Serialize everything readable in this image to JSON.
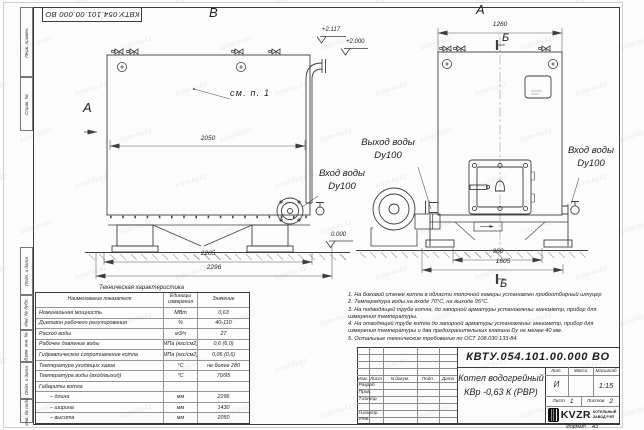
{
  "sheet": {
    "doc_number_top": "КВТУ.054.101.00.000 ВО",
    "format_label": "Формат",
    "format_value": "А3",
    "watermark": "kotel-kv.kz"
  },
  "margin_stamps": [
    "Перв. примен.",
    "Справ. №",
    "Подп. и дата",
    "Инв. № дубл.",
    "Взам. инв. №",
    "Подп. и дата",
    "Инв. № подл."
  ],
  "views": {
    "view_b": "В",
    "view_a": "А",
    "view_a_arrow": "А",
    "section_top": "Б",
    "section_bottom": "Б",
    "see_note": "см. п. 1",
    "elev_pipe": "+2.117",
    "elev_top": "+2.000",
    "elev_ground": "0.000",
    "dim_body": "2050",
    "dim_frame": "2205",
    "dim_total": "2296",
    "dim_width_top": "1260",
    "dim_width_base": "960",
    "dim_width_total": "1605",
    "outlet_label": "Выход воды",
    "outlet_dn": "Dy100",
    "inlet_left_label": "Вход воды",
    "inlet_left_dn": "Dy100",
    "inlet_right_label": "Вход воды",
    "inlet_right_dn": "Dy100"
  },
  "tech_table": {
    "title": "Техническая характеристика",
    "headers": [
      "Наименование показателя",
      "Единицы измерения",
      "Значение"
    ],
    "rows": [
      [
        "Номинальная мощность",
        "МВт",
        "0,63"
      ],
      [
        "Диапазон рабочего регулирования",
        "%",
        "40-110"
      ],
      [
        "Расход воды",
        "м3/ч",
        "27"
      ],
      [
        "Рабочее давление воды",
        "МПа (кгс/см2)",
        "0,6 (6,0)"
      ],
      [
        "Гидравлическое сопротивление котла",
        "МПа (кгс/см2)",
        "0,06 (0,6)"
      ],
      [
        "Температура уходящих газов",
        "°С",
        "не более 280"
      ],
      [
        "Температура воды (вход/выход)",
        "°С",
        "70/95"
      ],
      [
        "Габариты котла",
        "",
        ""
      ],
      [
        "– длина",
        "мм",
        "2296"
      ],
      [
        "– ширина",
        "мм",
        "1430"
      ],
      [
        "– высота",
        "мм",
        "2050"
      ]
    ]
  },
  "notes": {
    "lines": [
      "1.  На боковой стенке котла в области топочной камеры установлен пробоотборный штуцер",
      "2.  Температура воды на входе 70°С, на выходе 95°С.",
      "3.  На подводящей трубе котла, до запорной арматуры установлены: манометр, прибор для",
      "измерения температуры.",
      "4.  На отводящей трубе котла до запорной арматуры установлены: манометр, прибор для",
      "измерения температуры и два предохранительных клапана Dy не менее 40 мм.",
      "5.  Остальные технические требования по ОСТ 108.030.133-84."
    ]
  },
  "title_block": {
    "doc_number": "КВТУ.054.101.00.000 ВО",
    "title_line1": "Котел водогрейный",
    "title_line2": "КВр -0,63 К (РВР)",
    "rev_headers": [
      "Изм.",
      "Лист",
      "N докум.",
      "Подп.",
      "Дата"
    ],
    "sign_rows": [
      "Разраб.",
      "Пров.",
      "Т.контр.",
      "",
      "Н.контр.",
      "Утв."
    ],
    "lit_label": "Лит.",
    "mass_label": "Масса",
    "scale_label": "Масштаб",
    "lit_value": "И",
    "scale_value": "1:15",
    "sheet_label": "Лист",
    "sheet_value": "1",
    "sheets_label": "Листов",
    "sheets_value": "2",
    "logo_text": "KVZR",
    "company_line1": "КОТЕЛЬНЫЙ",
    "company_line2": "ЗАВОД РЭП"
  }
}
